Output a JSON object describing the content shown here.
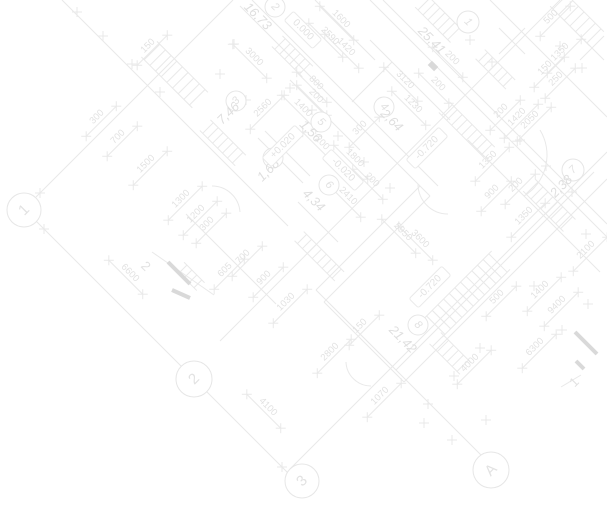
{
  "drawing": {
    "title": "floor-plan-blueprint-watermark",
    "colors": {
      "background": "#ffffff",
      "line": "#e9e9e9",
      "circle": "#e6e6e6",
      "text": "#e2e2e2",
      "area_text": "#dfdfdf",
      "section_mark": "#d9d9d9"
    },
    "grid_bubbles": [
      {
        "t": "1",
        "x": 24,
        "y": 210,
        "rad": 17,
        "r": -45
      },
      {
        "t": "2",
        "x": 194,
        "y": 379,
        "rad": 18,
        "r": -45
      },
      {
        "t": "3",
        "x": 302,
        "y": 481,
        "rad": 17,
        "r": -45
      },
      {
        "t": "A",
        "x": 491,
        "y": 470,
        "rad": 18,
        "r": -45
      }
    ],
    "room_bubbles": [
      {
        "t": "2",
        "x": 275,
        "y": 7,
        "rad": 10,
        "r": 45
      },
      {
        "t": "1",
        "x": 468,
        "y": 22,
        "rad": 11,
        "r": 45
      },
      {
        "t": "3",
        "x": 236,
        "y": 101,
        "rad": 10,
        "r": -45
      },
      {
        "t": "4",
        "x": 384,
        "y": 107,
        "rad": 10,
        "r": 45
      },
      {
        "t": "5",
        "x": 321,
        "y": 122,
        "rad": 10,
        "r": 45
      },
      {
        "t": "7",
        "x": 273,
        "y": 158,
        "rad": 10,
        "r": -45
      },
      {
        "t": "6",
        "x": 329,
        "y": 185,
        "rad": 10,
        "r": 45
      },
      {
        "t": "7",
        "x": 573,
        "y": 170,
        "rad": 11,
        "r": -45
      },
      {
        "t": "8",
        "x": 418,
        "y": 325,
        "rad": 10,
        "r": 45
      }
    ],
    "labels": [
      {
        "t": "150",
        "x": 148,
        "y": 46,
        "r": -45,
        "k": "dim"
      },
      {
        "t": "300",
        "x": 97,
        "y": 117,
        "r": -45,
        "k": "dim"
      },
      {
        "t": "700",
        "x": 118,
        "y": 137,
        "r": -45,
        "k": "dim"
      },
      {
        "t": "1500",
        "x": 146,
        "y": 164,
        "r": -45,
        "k": "dim"
      },
      {
        "t": "1300",
        "x": 181,
        "y": 199,
        "r": -45,
        "k": "dim"
      },
      {
        "t": "1200",
        "x": 196,
        "y": 214,
        "r": -45,
        "k": "dim"
      },
      {
        "t": "3000",
        "x": 254,
        "y": 57,
        "r": 45,
        "k": "dim"
      },
      {
        "t": "2590",
        "x": 330,
        "y": 36,
        "r": 45,
        "k": "dim"
      },
      {
        "t": "1600",
        "x": 341,
        "y": 19,
        "r": 45,
        "k": "dim"
      },
      {
        "t": "1420",
        "x": 346,
        "y": 47,
        "r": 45,
        "k": "dim"
      },
      {
        "t": "800",
        "x": 316,
        "y": 83,
        "r": 45,
        "k": "dim"
      },
      {
        "t": "200",
        "x": 316,
        "y": 96,
        "r": 45,
        "k": "dim"
      },
      {
        "t": "1400",
        "x": 303,
        "y": 108,
        "r": 45,
        "k": "dim"
      },
      {
        "t": "200",
        "x": 322,
        "y": 143,
        "r": 45,
        "k": "dim"
      },
      {
        "t": "3120",
        "x": 405,
        "y": 80,
        "r": 45,
        "k": "dim"
      },
      {
        "t": "200",
        "x": 438,
        "y": 84,
        "r": 45,
        "k": "dim"
      },
      {
        "t": "1230",
        "x": 413,
        "y": 104,
        "r": 45,
        "k": "dim"
      },
      {
        "t": "200",
        "x": 452,
        "y": 58,
        "r": 45,
        "k": "dim"
      },
      {
        "t": "200",
        "x": 501,
        "y": 111,
        "r": -45,
        "k": "dim"
      },
      {
        "t": "2050",
        "x": 530,
        "y": 120,
        "r": -45,
        "k": "dim"
      },
      {
        "t": "1350",
        "x": 560,
        "y": 52,
        "r": -45,
        "k": "dim"
      },
      {
        "t": "500",
        "x": 551,
        "y": 17,
        "r": -45,
        "k": "dim"
      },
      {
        "t": "150",
        "x": 545,
        "y": 68,
        "r": -45,
        "k": "dim"
      },
      {
        "t": "250",
        "x": 556,
        "y": 79,
        "r": -45,
        "k": "dim"
      },
      {
        "t": "1420",
        "x": 517,
        "y": 117,
        "r": -45,
        "k": "dim"
      },
      {
        "t": "1350",
        "x": 488,
        "y": 160,
        "r": -45,
        "k": "dim"
      },
      {
        "t": "200",
        "x": 516,
        "y": 185,
        "r": -45,
        "k": "dim"
      },
      {
        "t": "900",
        "x": 492,
        "y": 192,
        "r": -45,
        "k": "dim"
      },
      {
        "t": "1350",
        "x": 524,
        "y": 216,
        "r": -45,
        "k": "dim"
      },
      {
        "t": "2100",
        "x": 586,
        "y": 250,
        "r": -45,
        "k": "dim"
      },
      {
        "t": "300",
        "x": 360,
        "y": 128,
        "r": -45,
        "k": "dim"
      },
      {
        "t": "1800",
        "x": 355,
        "y": 158,
        "r": 45,
        "k": "dim"
      },
      {
        "t": "200",
        "x": 372,
        "y": 180,
        "r": 45,
        "k": "dim"
      },
      {
        "t": "2410",
        "x": 348,
        "y": 196,
        "r": 45,
        "k": "dim"
      },
      {
        "t": "2560",
        "x": 263,
        "y": 108,
        "r": -45,
        "k": "dim"
      },
      {
        "t": "5950",
        "x": 403,
        "y": 232,
        "r": 45,
        "k": "dim"
      },
      {
        "t": "3600",
        "x": 420,
        "y": 239,
        "r": 45,
        "k": "dim"
      },
      {
        "t": "6600",
        "x": 130,
        "y": 273,
        "r": 45,
        "k": "dim"
      },
      {
        "t": "4100",
        "x": 268,
        "y": 407,
        "r": 45,
        "k": "dim"
      },
      {
        "t": "1030",
        "x": 286,
        "y": 302,
        "r": -45,
        "k": "dim"
      },
      {
        "t": "900",
        "x": 264,
        "y": 278,
        "r": -45,
        "k": "dim"
      },
      {
        "t": "605",
        "x": 225,
        "y": 270,
        "r": -45,
        "k": "dim"
      },
      {
        "t": "700",
        "x": 243,
        "y": 257,
        "r": -45,
        "k": "dim"
      },
      {
        "t": "300",
        "x": 207,
        "y": 224,
        "r": -45,
        "k": "dim"
      },
      {
        "t": "2800",
        "x": 330,
        "y": 352,
        "r": -45,
        "k": "dim"
      },
      {
        "t": "150",
        "x": 360,
        "y": 326,
        "r": -45,
        "k": "dim"
      },
      {
        "t": "1070",
        "x": 380,
        "y": 396,
        "r": -45,
        "k": "dim"
      },
      {
        "t": "4000",
        "x": 470,
        "y": 363,
        "r": -45,
        "k": "dim"
      },
      {
        "t": "6300",
        "x": 535,
        "y": 347,
        "r": -45,
        "k": "dim"
      },
      {
        "t": "9400",
        "x": 557,
        "y": 305,
        "r": -45,
        "k": "dim"
      },
      {
        "t": "1400",
        "x": 540,
        "y": 290,
        "r": -45,
        "k": "dim"
      },
      {
        "t": "500",
        "x": 497,
        "y": 297,
        "r": -45,
        "k": "dim"
      },
      {
        "t": "16,73",
        "x": 258,
        "y": 16,
        "r": 45,
        "k": "area"
      },
      {
        "t": "25,41",
        "x": 432,
        "y": 40,
        "r": 45,
        "k": "area"
      },
      {
        "t": "7,46",
        "x": 228,
        "y": 113,
        "r": -45,
        "k": "area"
      },
      {
        "t": "2,64",
        "x": 392,
        "y": 120,
        "r": 45,
        "k": "area"
      },
      {
        "t": "1,56",
        "x": 311,
        "y": 131,
        "r": 45,
        "k": "area"
      },
      {
        "t": "1,68",
        "x": 268,
        "y": 170,
        "r": -45,
        "k": "area"
      },
      {
        "t": "4,34",
        "x": 314,
        "y": 200,
        "r": 45,
        "k": "area"
      },
      {
        "t": "2,38",
        "x": 561,
        "y": 186,
        "r": -45,
        "k": "area"
      },
      {
        "t": "21,42",
        "x": 403,
        "y": 339,
        "r": 45,
        "k": "area"
      },
      {
        "t": "0.000",
        "x": 303,
        "y": 30,
        "r": 45,
        "k": "elev"
      },
      {
        "t": "-0.020",
        "x": 343,
        "y": 170,
        "r": 45,
        "k": "elev"
      },
      {
        "t": "+0.020",
        "x": 283,
        "y": 146,
        "r": -45,
        "k": "elev"
      },
      {
        "t": "-0.720",
        "x": 427,
        "y": 148,
        "r": -45,
        "k": "elev"
      },
      {
        "t": "-0.720",
        "x": 430,
        "y": 287,
        "r": -45,
        "k": "elev"
      },
      {
        "t": "2",
        "x": 146,
        "y": 266,
        "r": 45,
        "k": "section"
      },
      {
        "t": "1",
        "x": 574,
        "y": 382,
        "r": -45,
        "k": "section"
      }
    ],
    "segments": [
      [
        36,
        197,
        233,
        0
      ],
      [
        36,
        221,
        290,
        475
      ],
      [
        220,
        341,
        560,
        0
      ],
      [
        290,
        469,
        607,
        152
      ],
      [
        330,
        304,
        484,
        458
      ],
      [
        240,
        6,
        430,
        196
      ],
      [
        252,
        0,
        438,
        186
      ],
      [
        430,
        196,
        324,
        302
      ],
      [
        420,
        186,
        316,
        290
      ],
      [
        324,
        302,
        404,
        382
      ],
      [
        316,
        290,
        396,
        370
      ],
      [
        404,
        382,
        607,
        179
      ],
      [
        396,
        370,
        594,
        172
      ],
      [
        370,
        0,
        607,
        237
      ],
      [
        383,
        0,
        607,
        224
      ],
      [
        62,
        0,
        288,
        226
      ],
      [
        490,
        0,
        607,
        117
      ],
      [
        186,
        214,
        276,
        304
      ],
      [
        468,
        140,
        600,
        272
      ],
      [
        370,
        40,
        450,
        120
      ],
      [
        315,
        0,
        375,
        60
      ],
      [
        290,
        80,
        360,
        150
      ],
      [
        265,
        131,
        310,
        176
      ],
      [
        258,
        138,
        303,
        183
      ],
      [
        352,
        102,
        392,
        62
      ],
      [
        298,
        202,
        338,
        242
      ],
      [
        580,
        36,
        604,
        60
      ],
      [
        580,
        60,
        604,
        36
      ],
      [
        499,
        28,
        525,
        54
      ],
      [
        499,
        54,
        525,
        28
      ]
    ],
    "hatches": [
      {
        "x": 152,
        "y": 52,
        "ux": 0.7071,
        "uy": 0.7071,
        "n": 9,
        "step": 8,
        "len": 22
      },
      {
        "x": 280,
        "y": 44,
        "ux": 0.7071,
        "uy": 0.7071,
        "n": 6,
        "step": 7,
        "len": 15
      },
      {
        "x": 424,
        "y": 4,
        "ux": 0.7071,
        "uy": 0.7071,
        "n": 7,
        "step": 7,
        "len": 17
      },
      {
        "x": 560,
        "y": 2,
        "ux": 0.7071,
        "uy": 0.7071,
        "n": 7,
        "step": 8,
        "len": 20
      },
      {
        "x": 447,
        "y": 110,
        "ux": 0.7071,
        "uy": 0.7071,
        "n": 9,
        "step": 7,
        "len": 15
      },
      {
        "x": 532,
        "y": 188,
        "ux": 0.7071,
        "uy": 0.7071,
        "n": 8,
        "step": 7,
        "len": 17
      },
      {
        "x": 498,
        "y": 263,
        "ux": -0.7071,
        "uy": 0.7071,
        "n": 12,
        "step": 8,
        "len": 26
      },
      {
        "x": 438,
        "y": 341,
        "ux": 0.7071,
        "uy": 0.7071,
        "n": 6,
        "step": 7,
        "len": 16
      },
      {
        "x": 302,
        "y": 239,
        "ux": 0.7071,
        "uy": 0.7071,
        "n": 8,
        "step": 7,
        "len": 13
      },
      {
        "x": 483,
        "y": 57,
        "ux": 0.7071,
        "uy": 0.7071,
        "n": 6,
        "step": 7,
        "len": 13
      },
      {
        "x": 208,
        "y": 128,
        "ux": 0.7071,
        "uy": 0.7071,
        "n": 7,
        "step": 7,
        "len": 15
      },
      {
        "x": 183,
        "y": 269,
        "ux": 0.7071,
        "uy": 0.7071,
        "n": 4,
        "step": 7,
        "len": 11
      }
    ],
    "arcs": [
      "M212,186 A28,28 0 0 1 240,212",
      "M540,130 A48,48 0 0 1 524,196",
      "M418,184 A30,30 0 0 0 448,214",
      "M346,362 A25,25 0 0 0 371,386"
    ],
    "ticks": [
      [
        40,
        193
      ],
      [
        77,
        12
      ],
      [
        103,
        36
      ],
      [
        132,
        64
      ],
      [
        160,
        92
      ],
      [
        234,
        44
      ],
      [
        44,
        229
      ],
      [
        186,
        371
      ],
      [
        202,
        387
      ],
      [
        282,
        467
      ],
      [
        290,
        88
      ],
      [
        312,
        110
      ],
      [
        338,
        136
      ],
      [
        364,
        162
      ],
      [
        390,
        188
      ],
      [
        246,
        100
      ],
      [
        220,
        74
      ],
      [
        470,
        40
      ],
      [
        492,
        62
      ],
      [
        560,
        46
      ],
      [
        582,
        68
      ],
      [
        520,
        140
      ],
      [
        546,
        166
      ],
      [
        572,
        192
      ],
      [
        586,
        234
      ],
      [
        534,
        286
      ],
      [
        562,
        330
      ],
      [
        588,
        304
      ],
      [
        480,
        348
      ],
      [
        454,
        376
      ],
      [
        428,
        404
      ],
      [
        424,
        423
      ],
      [
        452,
        440
      ],
      [
        486,
        420
      ]
    ],
    "section_marks": [
      {
        "thick": [
          [
            168,
            262,
            190,
            284
          ],
          [
            172,
            290,
            190,
            298
          ]
        ],
        "thin": [
          [
            152,
            252,
            214,
            295
          ]
        ]
      },
      {
        "thick": [
          [
            575,
            332,
            597,
            354
          ],
          [
            576,
            361,
            584,
            369
          ]
        ],
        "thin": [
          [
            561,
            387,
            581,
            375
          ]
        ]
      }
    ],
    "filled_rects": [
      {
        "cx": 433,
        "cy": 66,
        "w": 9,
        "h": 6,
        "rot": 45
      }
    ]
  }
}
